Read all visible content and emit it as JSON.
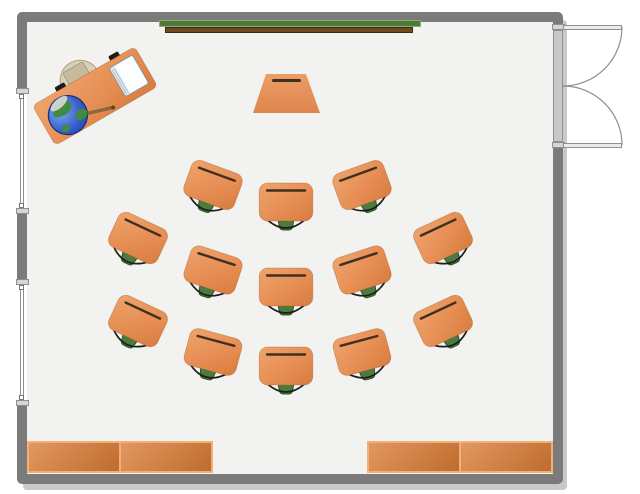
{
  "scene": {
    "kind": "classroom-floor-plan",
    "student_desk_count": 13,
    "bookcase_count": 2,
    "window_count": 2
  },
  "colors": {
    "outside": "#ffffff",
    "floor": "#f2f2f0",
    "wall": "#7b7b7b",
    "shadow": "rgba(148,148,148,0.5)",
    "desk_top_light": "#efa46d",
    "desk_top_dark": "#d87c3e",
    "desk_groove": "#42301e",
    "chair_green": "#4c7b3f",
    "chair_green_dark": "#2d5226",
    "chair_arc": "#1e1e1e",
    "board_green": "#4e7a3a",
    "board_green_light": "#8fae6d",
    "tray_brown": "#6f4a21",
    "tray_brown_dark": "#3c2910",
    "bookcase_light": "#e2985f",
    "bookcase_dark": "#bf6c2d",
    "bookcase_border": "#f0b07a",
    "door_fill": "#ececec",
    "door_frame": "#8f8f8f",
    "door_recess": "#c8c8c8",
    "window_cap": "#d6d6d6",
    "window_line": "#8f8f8f",
    "teacher_chair": "#d9d0b8",
    "teacher_chair_seat": "#c7bb9d",
    "globe_ocean": "#2e56c6",
    "globe_land": "#3f8b41",
    "globe_pointer": "#8a6a3c",
    "notepad": "#fbfdfe"
  },
  "room": {
    "x": 17,
    "y": 12,
    "w": 546,
    "h": 472,
    "wall_thickness": 10
  },
  "chalkboard": {
    "board": {
      "x": 159,
      "y": 20,
      "w": 262,
      "h": 7
    },
    "tray": {
      "x": 165,
      "y": 27,
      "w": 248,
      "h": 6
    }
  },
  "lectern": {
    "x": 253,
    "y": 74,
    "w": 67,
    "h": 39
  },
  "teacher_desk": {
    "x": 95,
    "y": 96,
    "rotation": -30
  },
  "student_desks": [
    {
      "x": 213,
      "y": 185,
      "rotation": 20
    },
    {
      "x": 286,
      "y": 202,
      "rotation": 0
    },
    {
      "x": 362,
      "y": 185,
      "rotation": -20
    },
    {
      "x": 138,
      "y": 238,
      "rotation": 25
    },
    {
      "x": 213,
      "y": 270,
      "rotation": 18
    },
    {
      "x": 286,
      "y": 287,
      "rotation": 0
    },
    {
      "x": 362,
      "y": 270,
      "rotation": -18
    },
    {
      "x": 443,
      "y": 238,
      "rotation": -25
    },
    {
      "x": 138,
      "y": 321,
      "rotation": 25
    },
    {
      "x": 213,
      "y": 352,
      "rotation": 15
    },
    {
      "x": 286,
      "y": 366,
      "rotation": 0
    },
    {
      "x": 362,
      "y": 352,
      "rotation": -15
    },
    {
      "x": 443,
      "y": 321,
      "rotation": -25
    }
  ],
  "windows": [
    {
      "top": 88,
      "bottom": 214
    },
    {
      "top": 279,
      "bottom": 406
    }
  ],
  "door": {
    "x": 553,
    "top": 24,
    "bottom": 148,
    "leaf_length": 59,
    "style": "double-swing-out"
  },
  "bookcases": [
    {
      "x": 27,
      "y": 441,
      "w": 186,
      "h": 32,
      "sections": 2
    },
    {
      "x": 367,
      "y": 441,
      "w": 186,
      "h": 32,
      "sections": 2
    }
  ]
}
